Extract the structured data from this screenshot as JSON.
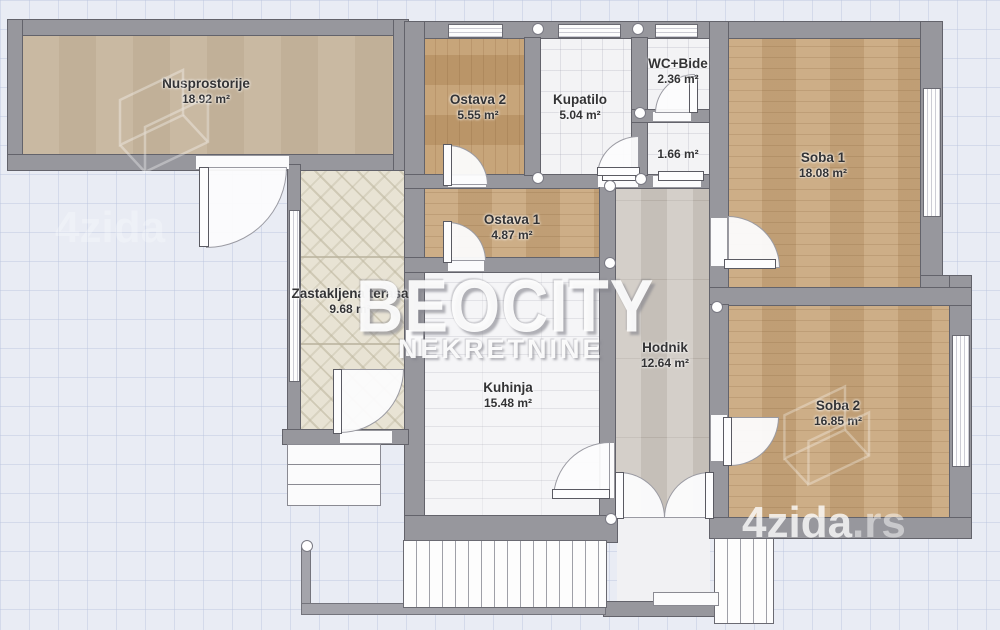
{
  "title": "Floor plan",
  "rooms": {
    "nusprostorije": {
      "name": "Nusprostorije",
      "area": "18.92 m²"
    },
    "ostava2": {
      "name": "Ostava 2",
      "area": "5.55 m²"
    },
    "kupatilo": {
      "name": "Kupatilo",
      "area": "5.04 m²"
    },
    "wc_bide": {
      "name": "WC+Bide",
      "area": "2.36 m²"
    },
    "room166": {
      "name": "",
      "area": "1.66 m²"
    },
    "soba1": {
      "name": "Soba 1",
      "area": "18.08 m²"
    },
    "ostava1": {
      "name": "Ostava 1",
      "area": "4.87 m²"
    },
    "terasa": {
      "name": "Zastakljena terasa",
      "area": "9.68 m²"
    },
    "kuhinja": {
      "name": "Kuhinja",
      "area": "15.48 m²"
    },
    "hodnik": {
      "name": "Hodnik",
      "area": "12.64 m²"
    },
    "soba2": {
      "name": "Soba 2",
      "area": "16.85 m²"
    }
  },
  "watermarks": {
    "agency_name": "BEOCITY",
    "agency_sub": "NEKRETNINE",
    "portal_name": "4zida",
    "portal_tld": ".rs",
    "portal_faint": "4zida"
  },
  "colors": {
    "background": "#e9ecf4",
    "wall": "#97979d",
    "wood_floor": "#c9a87e",
    "tan_floor": "#c6b59d",
    "tile_floor": "#f3f3f5",
    "hall_floor": "#ccc6bf",
    "terrace_floor": "#e8e3d4",
    "watermark": "#ffffff"
  }
}
